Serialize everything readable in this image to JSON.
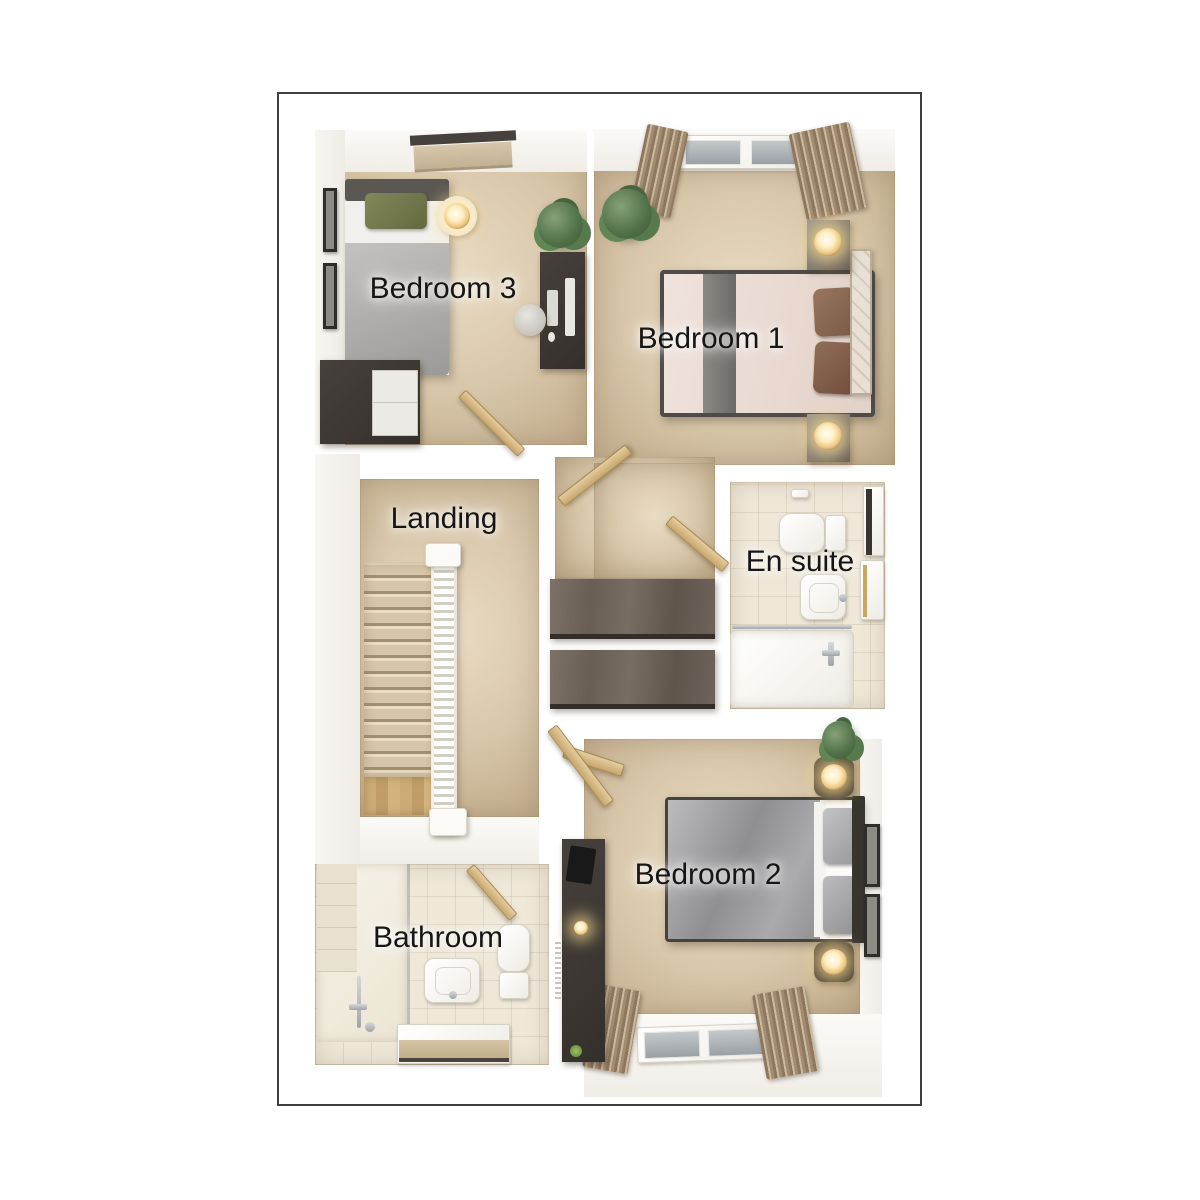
{
  "plan": {
    "rooms": {
      "bedroom3": {
        "label": "Bedroom 3"
      },
      "bedroom1": {
        "label": "Bedroom 1"
      },
      "landing": {
        "label": "Landing"
      },
      "ensuite": {
        "label": "En suite"
      },
      "bedroom2": {
        "label": "Bedroom 2"
      },
      "bathroom": {
        "label": "Bathroom"
      }
    },
    "colors": {
      "panel_border": "#3e3e3e",
      "wall": "#ffffff",
      "carpet": "#d8c6a9",
      "carpet_highlight": "#e9dcc3",
      "tile": "#efe8d9",
      "wood_dark": "#47413c",
      "wardrobe_wood": "#6e635a",
      "door_wood": "#d6b886",
      "stair_carpet": "#d6c5a8",
      "lamp_glow": "#fdeec4",
      "plant_green": "#4f7048",
      "bed1_bedding": "#ecdfd7",
      "bed1_runner": "#7c7a77",
      "pillow_brown": "#8a6a55",
      "bed2_duvet": "#a4a4a6",
      "bed3_duvet": "#b0aeac",
      "pillow_green": "#757a4b",
      "label_text": "#161616"
    }
  }
}
